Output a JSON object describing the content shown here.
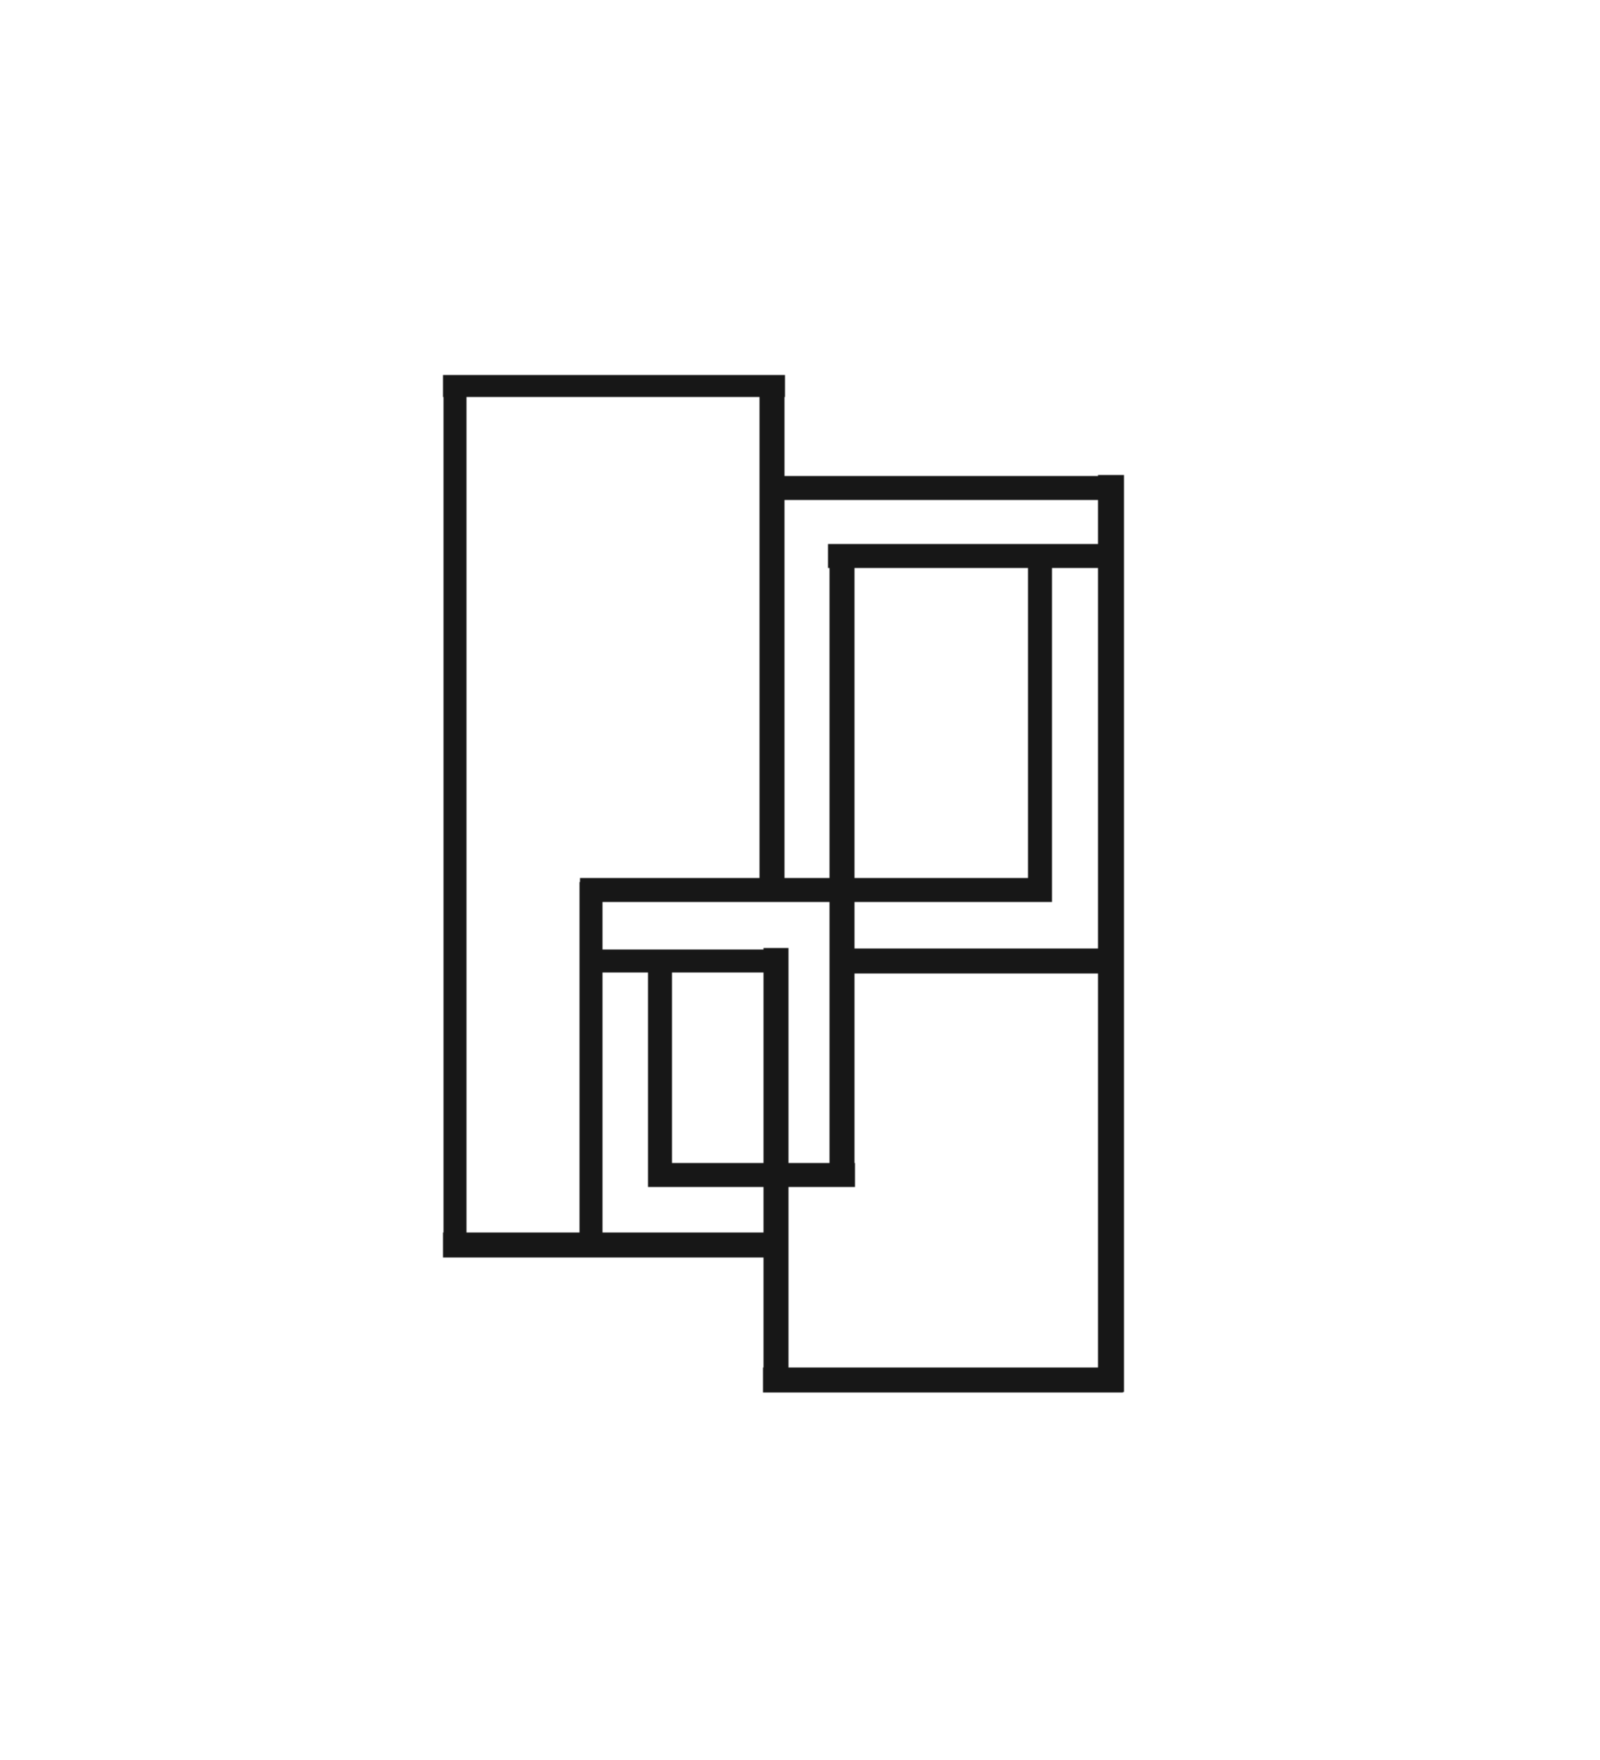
{
  "artwork": {
    "description": "Minimalist hand-drawn abstract line art: six interlocking rectangular frames drawn in thick near-black ink on a white background, overlapping so edges pass in front of and behind one another",
    "background_color": "#ffffff",
    "ink_color": "#171717",
    "canvas": {
      "width": 1600,
      "height": 1760
    },
    "frames": [
      {
        "name": "tall-left-rect",
        "x": 443,
        "y": 375,
        "x2": 785,
        "y2": 1257
      },
      {
        "name": "upper-right-outer-rect",
        "x": 760,
        "y": 475,
        "x2": 1123,
        "y2": 975
      },
      {
        "name": "upper-right-inner-rect",
        "x": 828,
        "y": 544,
        "x2": 1052,
        "y2": 902
      },
      {
        "name": "middle-left-rect",
        "x": 580,
        "y": 878,
        "x2": 788,
        "y2": 1257
      },
      {
        "name": "center-small-rect",
        "x": 648,
        "y": 950,
        "x2": 855,
        "y2": 1187
      },
      {
        "name": "lower-right-rect",
        "x": 763,
        "y": 948,
        "x2": 1123,
        "y2": 1392
      }
    ],
    "strokes": [
      {
        "name": "tall-left-rect-left-edge",
        "orient": "v",
        "x": 455,
        "y1": 375,
        "y2": 1257,
        "w": 23
      },
      {
        "name": "tall-left-rect-right-edge-upper",
        "orient": "v",
        "x": 772,
        "y1": 375,
        "y2": 902,
        "w": 25
      },
      {
        "name": "lower-right-rect-left-edge",
        "orient": "v",
        "x": 776,
        "y1": 948,
        "y2": 1392,
        "w": 25
      },
      {
        "name": "middle-left-rect-left-edge",
        "orient": "v",
        "x": 591,
        "y1": 882,
        "y2": 1257,
        "w": 23
      },
      {
        "name": "center-small-rect-left-edge",
        "orient": "v",
        "x": 660,
        "y1": 950,
        "y2": 1187,
        "w": 24
      },
      {
        "name": "inner-rect-left-and-small-rect-right-edge",
        "orient": "v",
        "x": 842,
        "y1": 545,
        "y2": 1187,
        "w": 25
      },
      {
        "name": "upper-right-inner-rect-right-edge",
        "orient": "v",
        "x": 1040,
        "y1": 556,
        "y2": 902,
        "w": 24
      },
      {
        "name": "shared-far-right-edge",
        "orient": "v",
        "x": 1111,
        "y1": 475,
        "y2": 1392,
        "w": 26
      },
      {
        "name": "tall-left-rect-top-edge",
        "orient": "h",
        "y": 386,
        "x1": 443,
        "x2": 785,
        "w": 22
      },
      {
        "name": "upper-right-outer-rect-top-edge",
        "orient": "h",
        "y": 488,
        "x1": 760,
        "x2": 1123,
        "w": 24
      },
      {
        "name": "upper-right-inner-rect-top-edge",
        "orient": "h",
        "y": 556,
        "x1": 828,
        "x2": 1123,
        "w": 24
      },
      {
        "name": "middle-rect-top-and-inner-rect-bottom-edge",
        "orient": "h",
        "y": 890,
        "x1": 580,
        "x2": 1052,
        "w": 24
      },
      {
        "name": "center-small-rect-top-edge",
        "orient": "h",
        "y": 961,
        "x1": 580,
        "x2": 788,
        "w": 23
      },
      {
        "name": "upper-right-outer-rect-bottom-edge",
        "orient": "h",
        "y": 961,
        "x1": 843,
        "x2": 1123,
        "w": 25
      },
      {
        "name": "center-small-rect-bottom-edge",
        "orient": "h",
        "y": 1175,
        "x1": 648,
        "x2": 855,
        "w": 24
      },
      {
        "name": "tall-left-and-middle-rect-bottom-edge",
        "orient": "h",
        "y": 1245,
        "x1": 443,
        "x2": 788,
        "w": 25
      },
      {
        "name": "lower-right-rect-bottom-edge",
        "orient": "h",
        "y": 1380,
        "x1": 763,
        "x2": 1123,
        "w": 25
      }
    ]
  }
}
